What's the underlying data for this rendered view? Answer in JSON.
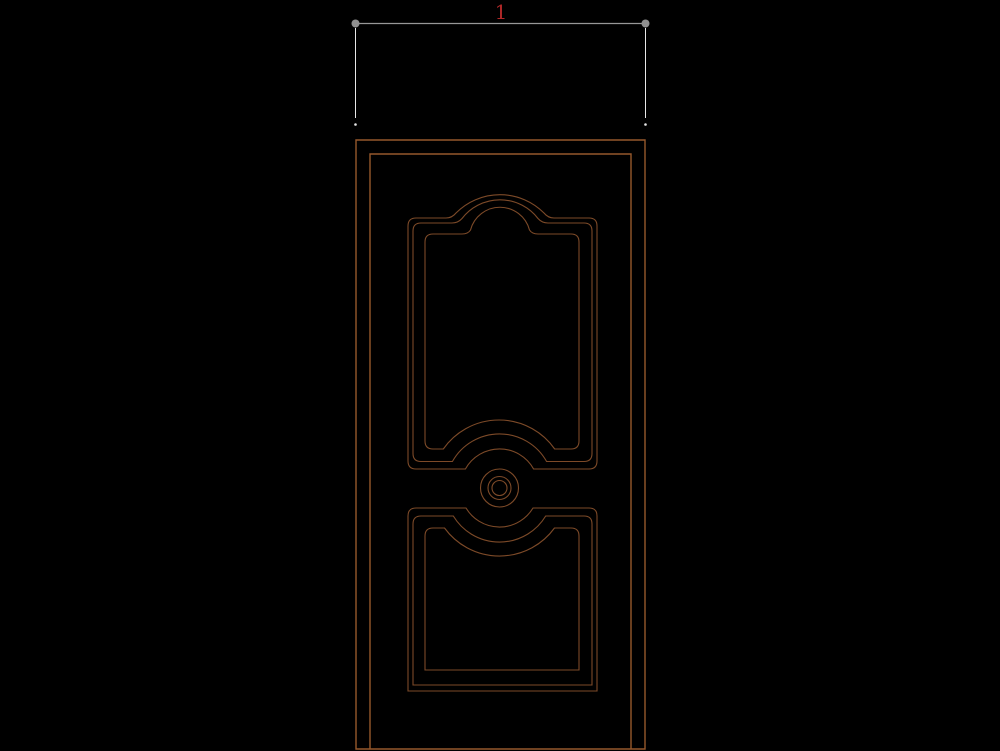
{
  "drawing": {
    "type": "cad-door-elevation",
    "dimension": {
      "label": "1"
    },
    "colors": {
      "background": "#000000",
      "door_outline": "#96582c",
      "panel_outline": "#7d4a28",
      "dimension_line": "#979797",
      "dimension_marker": "#8f8f8f",
      "extension_line": "#e6e6e6",
      "dimension_text": "#b02828"
    }
  }
}
